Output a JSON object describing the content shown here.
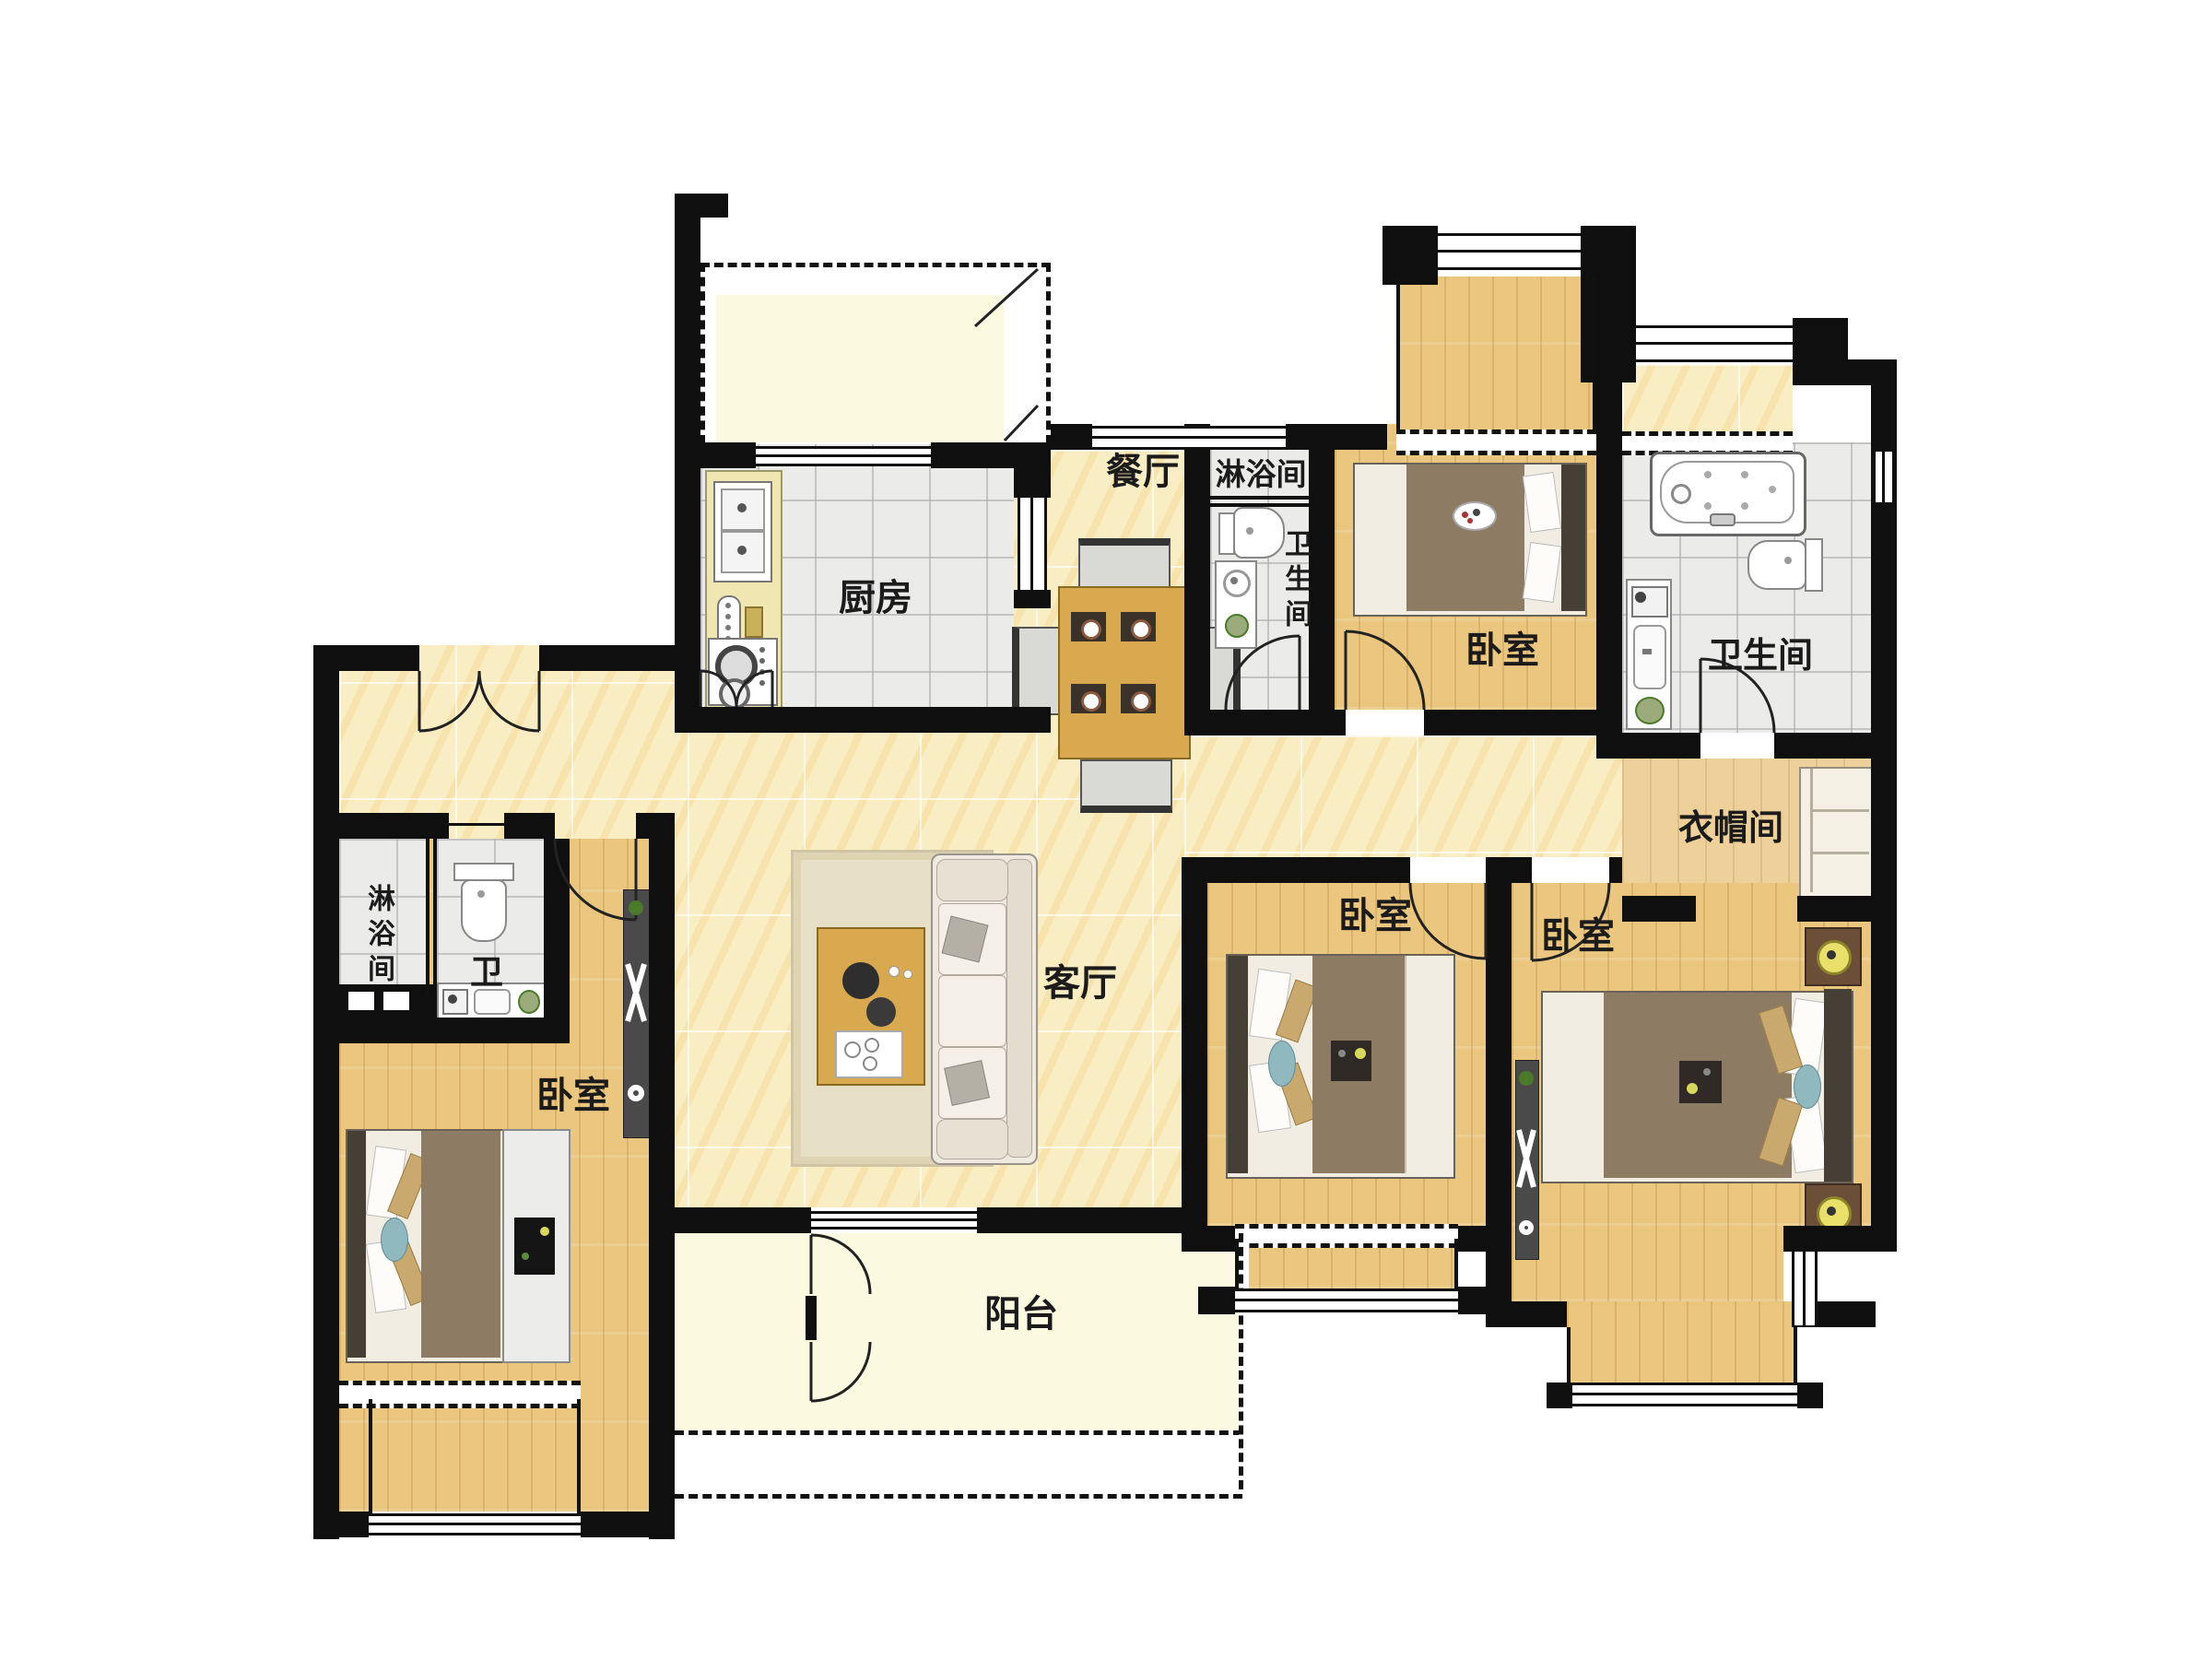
{
  "meta": {
    "type": "residential-floor-plan",
    "style": "top-down color render",
    "language": "zh-CN",
    "background": "#ffffff"
  },
  "palette": {
    "wall": "#0f0f0f",
    "marble_floor": "#f9edc4",
    "wood_floor": "#eac67f",
    "light_wood_floor": "#edd09a",
    "tile_floor": "#ebebea",
    "balcony_floor": "#fbfae0",
    "counter": "#f0e6b2",
    "blanket": "#8d7b64",
    "quilt": "#f1ede2",
    "headboard": "#463f35",
    "pillow_tan": "#c9a96e",
    "pillow_blue": "#8fb8bf",
    "table_wood": "#d8a94f",
    "lamp_yellow": "#e8e06a",
    "plant_green": "#4a7a2a"
  },
  "rooms": [
    {
      "id": "kitchen",
      "label": "厨房",
      "floor": "tile"
    },
    {
      "id": "dining",
      "label": "餐厅",
      "floor": "marble"
    },
    {
      "id": "shower-north",
      "label": "淋浴间",
      "floor": "tile"
    },
    {
      "id": "wc-north",
      "label": "卫生间",
      "floor": "tile",
      "orientation": "vertical"
    },
    {
      "id": "bedroom-ne",
      "label": "卧室",
      "floor": "wood"
    },
    {
      "id": "bathroom-east",
      "label": "卫生间",
      "floor": "tile"
    },
    {
      "id": "closet",
      "label": "衣帽间",
      "floor": "wood"
    },
    {
      "id": "living",
      "label": "客厅",
      "floor": "marble"
    },
    {
      "id": "bedroom-mid",
      "label": "卧室",
      "floor": "wood"
    },
    {
      "id": "bedroom-master",
      "label": "卧室",
      "floor": "wood"
    },
    {
      "id": "balcony",
      "label": "阳台",
      "floor": "pale"
    },
    {
      "id": "shower-west",
      "label": "淋浴间",
      "floor": "tile",
      "orientation": "vertical"
    },
    {
      "id": "wc-west",
      "label": "卫",
      "floor": "tile"
    },
    {
      "id": "bedroom-sw",
      "label": "卧室",
      "floor": "wood"
    }
  ],
  "furniture": [
    "dining-table-4-chairs",
    "kitchen-counter-sink-hob",
    "sofa",
    "rug",
    "coffee-table",
    "double-bed-ne",
    "double-bed-mid",
    "double-bed-master",
    "double-bed-sw",
    "nightstands-with-lamps",
    "tv-console",
    "coat-rack",
    "wardrobe-dresser",
    "bathtub",
    "toilet-x3",
    "vanity-x3",
    "built-in-closet"
  ],
  "openings": [
    "entry-double-door",
    "kitchen-double-door",
    "balcony-french-doors",
    "bedroom-doors-x4",
    "bathroom-doors-x2",
    "sliding-kitchen-pass",
    "bay-windows-x5"
  ]
}
